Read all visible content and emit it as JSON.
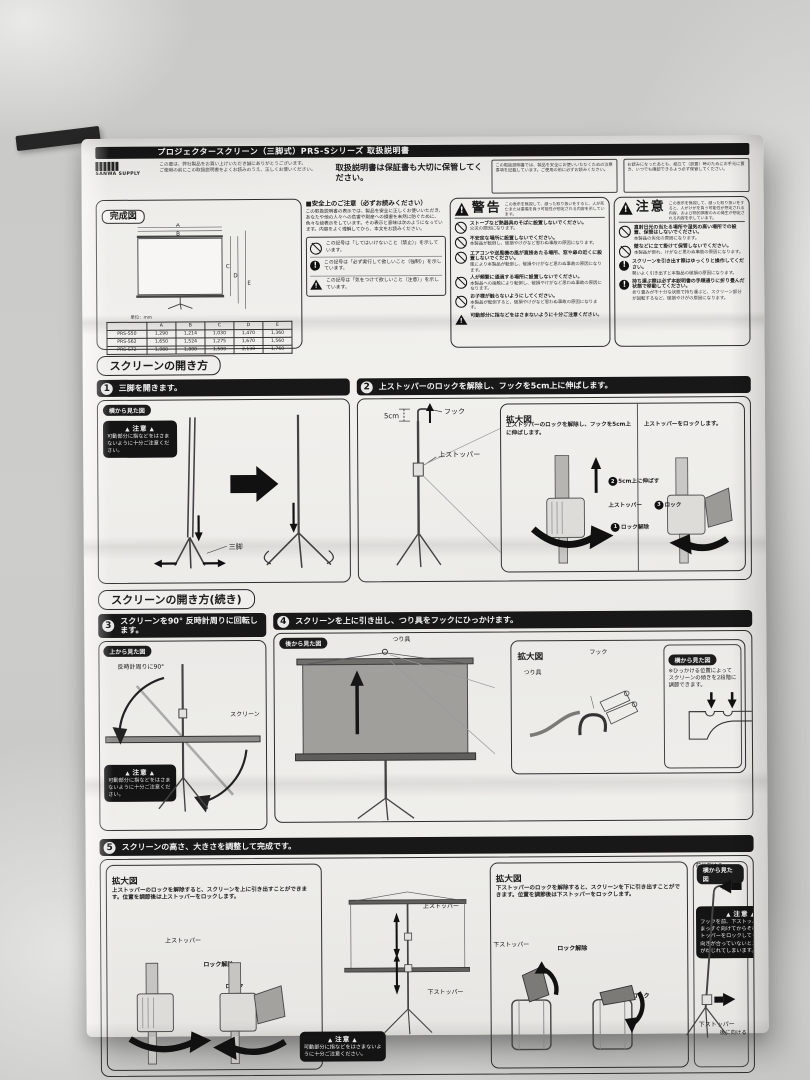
{
  "page": {
    "brand": "SANWA SUPPLY",
    "title": "プロジェクタースクリーン（三脚式）PRS-Sシリーズ 取扱説明書",
    "intro_line1": "この度は、弊社製品をお買い上げいただき誠にありがとうございます。",
    "intro_line2": "ご使用の前にこの取扱説明書をよくお読みのうえ、正しくお使いください。",
    "keep_note": "取扱説明書は保証書も大切に保管してください。",
    "fine_print_1": "この取扱説明書では、製品を安全にお使いいただくための注意事項を記載しています。ご使用の前に必ずお読みください。",
    "fine_print_2": "お読みになったあとも、組立て（設置）時のためにお手元に置き、いつでも確認できるよう必ず保管してください。"
  },
  "overview": {
    "label": "完成図",
    "unit_note": "単位：mm",
    "table": {
      "cols": [
        "型番",
        "A",
        "B",
        "C",
        "D",
        "E"
      ],
      "rows": [
        [
          "PRS-S50",
          "1,290",
          "1,214",
          "1,030",
          "1,470",
          "1,360"
        ],
        [
          "PRS-S62",
          "1,650",
          "1,524",
          "1,275",
          "1,670",
          "1,560"
        ],
        [
          "PRS-S72",
          "1,980",
          "1,800",
          "1,500",
          "2,130",
          "1,760"
        ]
      ]
    }
  },
  "safety": {
    "title": "■安全上のご注意（必ずお読みください）",
    "intro": "この取扱説明書の表示では、製品を安全に正しくお使いいただき、あなたや他の人々への危害や財産への損害を未然に防ぐために、色々な絵表示をしています。その表示と意味は次のようになっています。内容をよく理解してから、本文をお読みください。",
    "legend": [
      {
        "icon": "prohibit",
        "text": "この記号は「してはいけないこと（禁止）」を示しています。"
      },
      {
        "icon": "mandatory",
        "text": "この記号は「必ず実行して欲しいこと（強制）」を示しています。"
      },
      {
        "icon": "triangle",
        "text": "この記号は「気をつけて欲しいこと（注意）」を示しています。"
      }
    ]
  },
  "warning": {
    "title": "警告",
    "note": "この表示を無視して、誤った取り扱いをすると、人が死亡または重傷を負う可能性が想定される内容を示しています。",
    "items": [
      {
        "icon": "prohibit",
        "head": "ストーブなど熱器具のそばに設置しないでください。",
        "body": "火災の原因になります。"
      },
      {
        "icon": "prohibit",
        "head": "不安定な場所に設置しないでください。",
        "body": "本製品が転倒し、破損やけがなど思わぬ事故の原因になります。"
      },
      {
        "icon": "prohibit",
        "head": "エアコンや送風機の風が直接あたる場所、窓や扉の近くに設置しないでください。",
        "body": "風により本製品が転倒し、破損やけがなど思わぬ事故の原因になります。"
      },
      {
        "icon": "prohibit",
        "head": "人が頻繁に通過する場所に設置しないでください。",
        "body": "本製品への接触により転倒し、破損やけがなど思わぬ事故の原因になります。"
      },
      {
        "icon": "prohibit",
        "head": "お子様が触らないようにしてください。",
        "body": "本製品が転倒すると、破損やけがなど思わぬ事故の原因になります。"
      },
      {
        "icon": "triangle",
        "head": "可動部分に指などをはさまないように十分ご注意ください。",
        "body": ""
      }
    ]
  },
  "caution": {
    "title": "注意",
    "note": "この表示を無視して、誤った取り扱いをすると、人がけがを負う可能性が想定される内容、および物的損害のみの発生が想定される内容を示しています。",
    "items": [
      {
        "icon": "prohibit",
        "head": "直射日光の当たる場所や湿気の高い場所での設置、保管はしないでください。",
        "body": "本製品の劣化の原因になります。"
      },
      {
        "icon": "prohibit",
        "head": "壁などに立て掛けて保管しないでください。",
        "body": "本製品が倒れ、けがなど思わぬ事故の原因になります。"
      },
      {
        "icon": "mandatory",
        "head": "スクリーンを引き出す際はゆっくりと操作してください。",
        "body": "勢いよく引き出すと本製品の破損の原因になります。"
      },
      {
        "icon": "mandatory",
        "head": "持ち運ぶ際は必ず本説明書の手順通りに折り畳んだ状態で移動してください。",
        "body": "折り畳みが不十分な状態で持ち運ぶと、スクリーン部分が回転するなど、破損やけがの原因になります。"
      }
    ]
  },
  "sections": {
    "open": "スクリーンの開き方",
    "open_cont": "スクリーンの開き方(続き)"
  },
  "caution_pinch": {
    "title": "注意",
    "text": "可動部分に指などをはさまないように十分ご注意ください。"
  },
  "views": {
    "side": "横から見た図",
    "top": "上から見た図",
    "back": "後から見た図"
  },
  "steps": {
    "s1": {
      "num": "1",
      "title": "三脚を開きます。",
      "label_tripod": "三脚"
    },
    "s2": {
      "num": "2",
      "title": "上ストッパーのロックを解除し、フックを5cm上に伸ばします。",
      "label_5cm": "5cm",
      "label_hook": "フック",
      "label_stopper": "上ストッパー",
      "zoom_label": "拡大図",
      "sub1_head": "上ストッパーのロックを解除し、フックを5cm上に伸ばします。",
      "sub1_steps": [
        {
          "num": "2",
          "text": "5cm上に伸ばす"
        },
        {
          "num": "1",
          "text": "ロック解除"
        }
      ],
      "sub1_stopper": "上ストッパー",
      "sub2_head": "上ストッパーをロックします。",
      "sub2_steps": [
        {
          "num": "3",
          "text": "ロック"
        }
      ]
    },
    "s3": {
      "num": "3",
      "title": "スクリーンを90° 反時計周りに回転します。",
      "label_rotate": "反時計周りに90°",
      "label_screen": "スクリーン"
    },
    "s4": {
      "num": "4",
      "title": "スクリーンを上に引き出し、つり具をフックにひっかけます。",
      "label_hanger": "つり具",
      "zoom_label": "拡大図",
      "label_hook": "フック",
      "label_hanger2": "つり具",
      "side_note": "※ひっかける位置によってスクリーンの傾きを2段階に調節できます。"
    },
    "s5": {
      "num": "5",
      "title": "スクリーンの高さ、大きさを調整して完成です。",
      "zoom_label": "拡大図",
      "left_text": "上ストッパーのロックを解除すると、スクリーンを上に引き出すことができます。位置を調節後は上ストッパーをロックします。",
      "left_stopper": "上ストッパー",
      "left_unlock": "ロック解除",
      "left_lock": "ロック",
      "center_upper": "上ストッパー",
      "center_lower": "下ストッパー",
      "right_text": "下ストッパーのロックを解除すると、スクリーンを下に引き出すことができます。位置を調節後は下ストッパーをロックします。",
      "right_stopper": "下ストッパー",
      "right_unlock": "ロック解除",
      "right_lock": "ロック",
      "side_front": "前に向ける",
      "side_hook": "フック",
      "side_caution_title": "注意",
      "side_caution_text1": "フックを前、下ストッパーを後にまっすぐ向けてからそれぞれのストッパーをロックしてください。",
      "side_caution_text2": "向きが合っていないとスクリーンがねじれてしまいます。",
      "side_lower": "下ストッパー",
      "side_back": "後に向ける"
    }
  }
}
